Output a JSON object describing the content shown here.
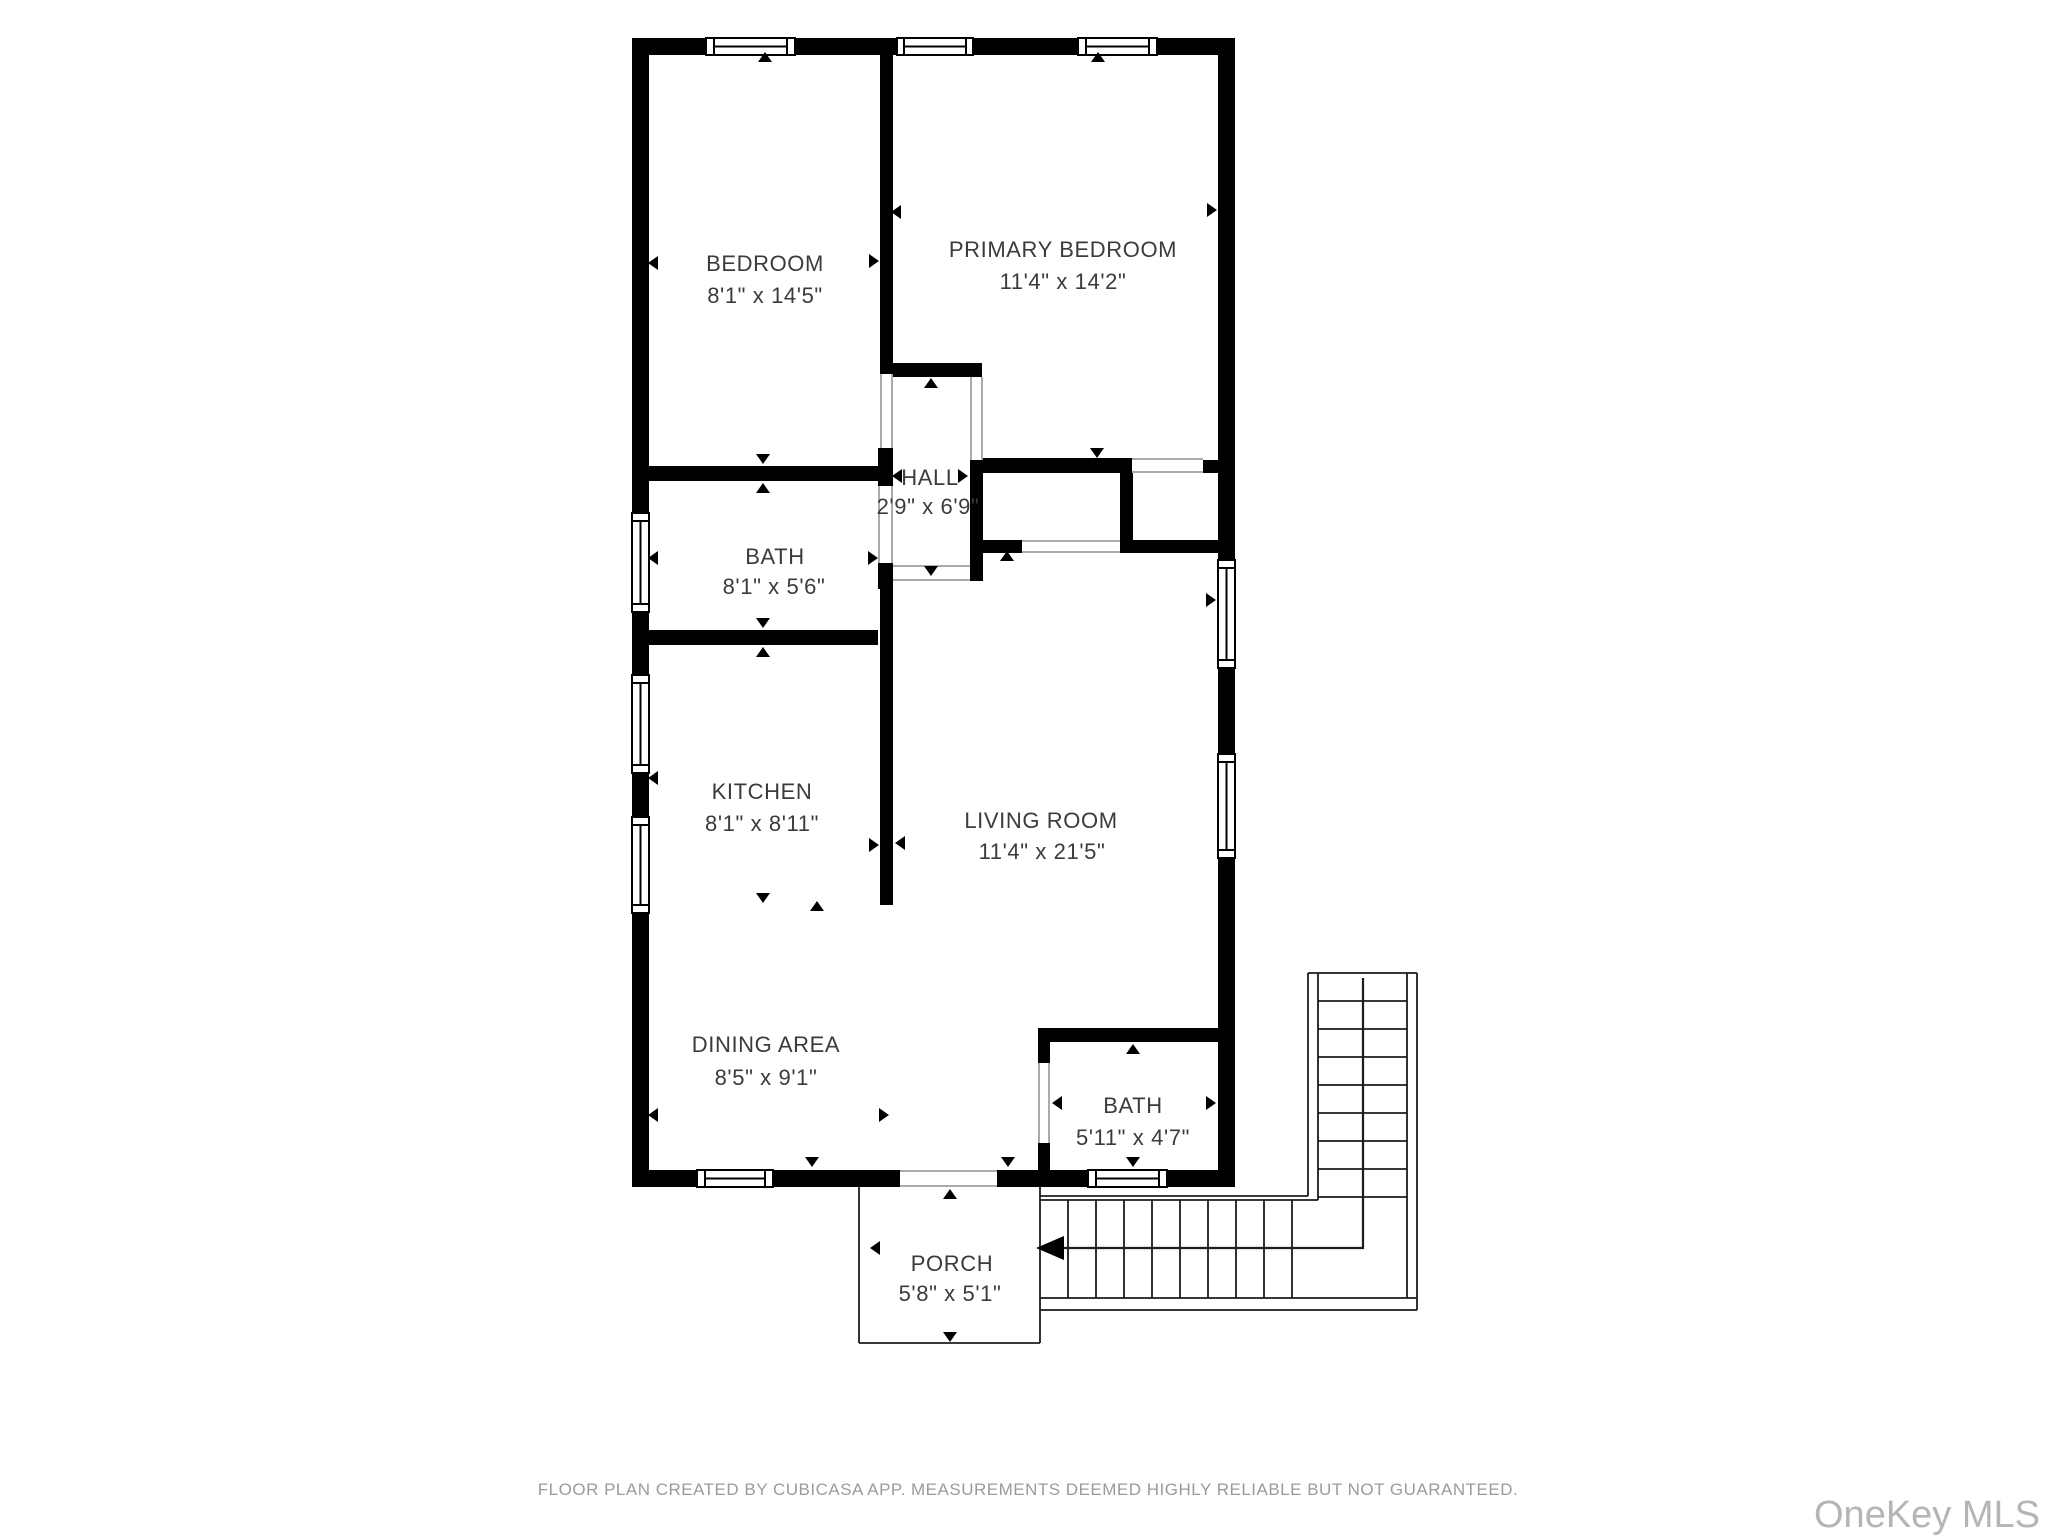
{
  "rooms": [
    {
      "name": "BEDROOM",
      "dims": "8'1\" x 14'5\""
    },
    {
      "name": "PRIMARY BEDROOM",
      "dims": "11'4\" x 14'2\""
    },
    {
      "name": "HALL",
      "dims": "2'9\" x 6'9\""
    },
    {
      "name": "BATH",
      "dims": "8'1\" x 5'6\""
    },
    {
      "name": "KITCHEN",
      "dims": "8'1\" x 8'11\""
    },
    {
      "name": "LIVING ROOM",
      "dims": "11'4\" x 21'5\""
    },
    {
      "name": "DINING AREA",
      "dims": "8'5\" x 9'1\""
    },
    {
      "name": "BATH",
      "dims": "5'11\" x 4'7\""
    },
    {
      "name": "PORCH",
      "dims": "5'8\" x 5'1\""
    }
  ],
  "footer": {
    "disclaimer": "FLOOR PLAN CREATED BY CUBICASA APP. MEASUREMENTS DEEMED HIGHLY RELIABLE BUT NOT GUARANTEED."
  },
  "watermark": {
    "text": "OneKey MLS"
  },
  "colors": {
    "wall": "#000000",
    "room_text": "#3b3b3b",
    "footer_text": "#9b9b9b",
    "watermark_text": "#b5b5b2",
    "background": "#ffffff"
  }
}
